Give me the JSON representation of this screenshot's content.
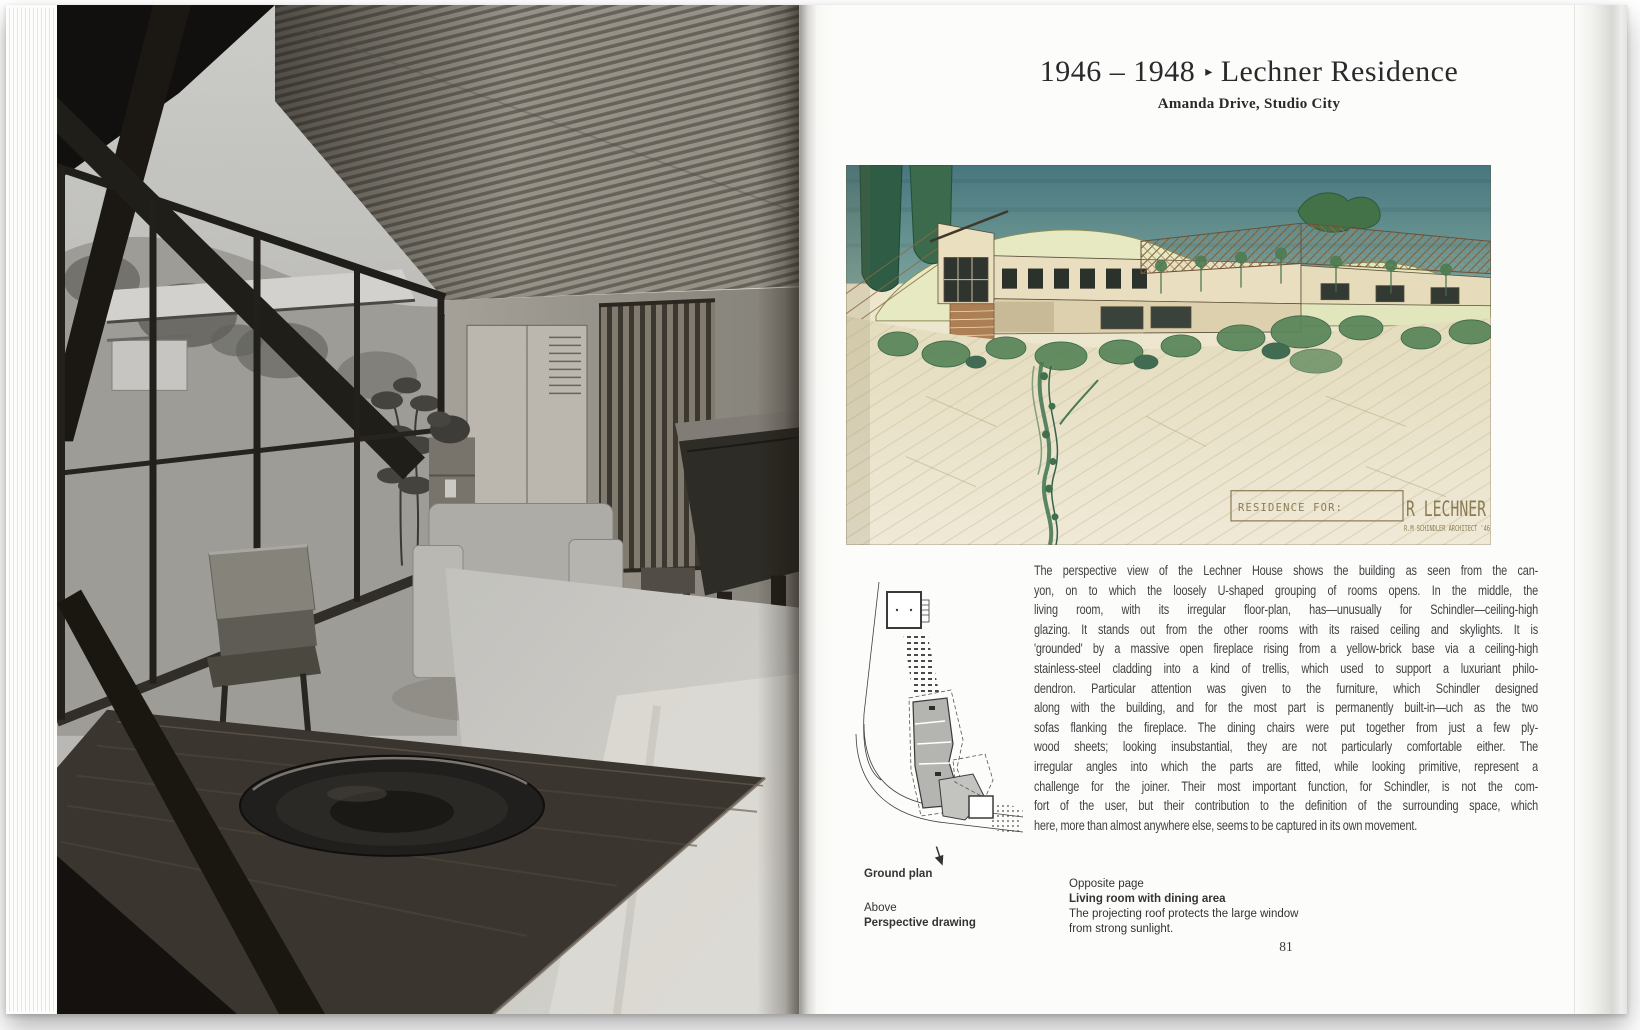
{
  "page_right": {
    "title": {
      "years": "1946 – 1948",
      "separator": "▸",
      "name": "Lechner Residence",
      "subtitle": "Amanda Drive, Studio City"
    },
    "body": {
      "lines": [
        "The perspective view of the Lechner House shows the building as seen from the can-",
        "yon, on to which the loosely U-shaped grouping of rooms opens. In the middle, the",
        "living room, with its irregular floor-plan, has—unusually for Schindler—ceiling-high",
        "glazing. It stands out from the other rooms with its raised ceiling and skylights. It is",
        "'grounded' by a massive open fireplace rising from a yellow-brick base via a ceiling-high",
        "stainless-steel cladding into a kind of trellis, which used to support a luxuriant philo-",
        "dendron. Particular attention was given to the furniture, which Schindler designed",
        "along with the building, and for the most part is permanently built-in—uch as the two",
        "sofas flanking the fireplace. The dining chairs were put together from just a few ply-",
        "wood sheets; looking insubstantial, they are not particularly comfortable either. The",
        "irregular angles into which the parts are fitted, while looking primitive, represent a",
        "challenge for the joiner. Their most important function, for Schindler, is not the com-",
        "fort of the user, but their contribution to the definition of the surrounding space, which",
        "here, more than almost anywhere else, seems to be captured in its own movement."
      ]
    },
    "captions_left": {
      "line1": "Ground plan",
      "line2": "Above",
      "line3": "Perspective drawing"
    },
    "captions_right": {
      "line1": "Opposite page",
      "line2": "Living room with dining area",
      "line3": "The projecting roof protects the large window",
      "line4": "from strong sunlight."
    },
    "drawing_label": {
      "small": "RESIDENCE FOR:",
      "large": "R LECHNER",
      "credit": "R.M SCHINDLER ARCHITECT '46"
    },
    "page_number": "81"
  },
  "colors": {
    "page": "#fbfbf9",
    "body_text": "#424244",
    "drawing_paper": "#ece4c9",
    "drawing_sky": "#4f8187",
    "drawing_green": "#4d7c52",
    "drawing_label": "#8b7b55"
  }
}
